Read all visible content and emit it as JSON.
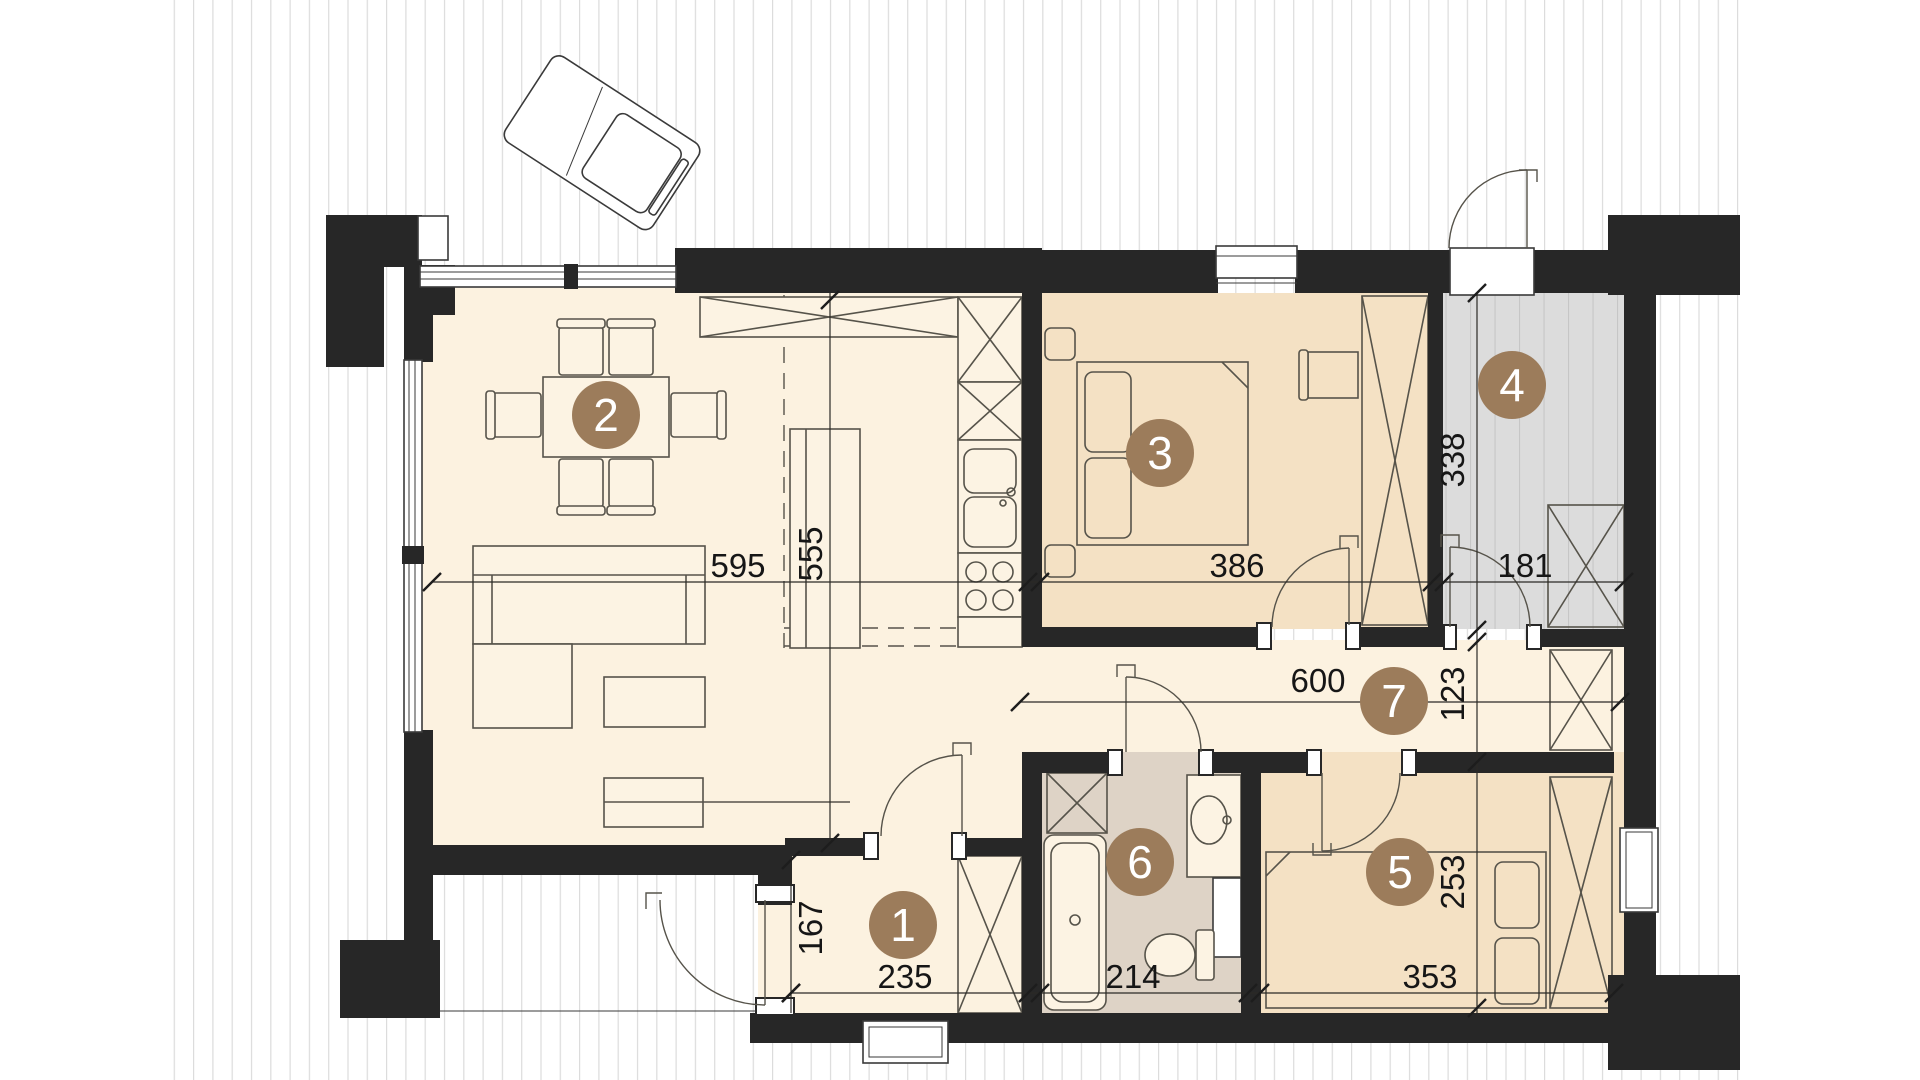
{
  "markers": {
    "m1": "1",
    "m2": "2",
    "m3": "3",
    "m4": "4",
    "m5": "5",
    "m6": "6",
    "m7": "7"
  },
  "dims": {
    "d595": "595",
    "d555": "555",
    "d386": "386",
    "d338": "338",
    "d181": "181",
    "d600": "600",
    "d123": "123",
    "d167": "167",
    "d235": "235",
    "d214": "214",
    "d353": "353",
    "d253": "253"
  },
  "colors": {
    "wall": "#272727",
    "room_cream": "#fcf2e0",
    "room_tan": "#f4e1c4",
    "room_terrace_gray": "#dcdcdc",
    "room_bath": "#ded3c6",
    "marker_brown": "#9c7c5b",
    "marker_text": "#ffffff",
    "line": "#56534a",
    "hatch": "#dcdcdc"
  }
}
